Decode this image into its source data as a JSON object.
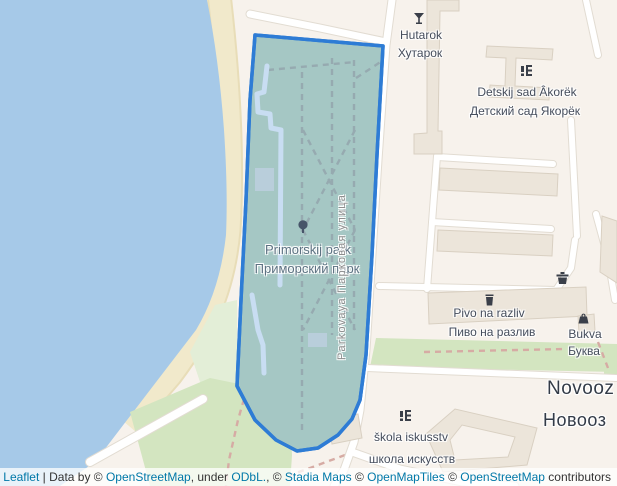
{
  "map": {
    "labels": {
      "hutarok": {
        "latin": "Hutarok",
        "cyrillic": "Хутарок"
      },
      "detsad": {
        "latin": "Detskij sad Âkorëk",
        "cyrillic": "Детский сад Якорёк"
      },
      "park": {
        "latin": "Primorskij park",
        "cyrillic": "Приморский парк"
      },
      "pivo": {
        "latin": "Pivo na razliv",
        "cyrillic": "Пиво на разлив"
      },
      "bukva": {
        "latin": "Bukva",
        "cyrillic": "Буква"
      },
      "shkola": {
        "latin": "škola iskusstv",
        "cyrillic": "школа искусств"
      },
      "place": {
        "latin": "Novooz",
        "cyrillic": "Новооз"
      },
      "street": {
        "text": "Parkovaya Парковая улица"
      }
    }
  },
  "colors": {
    "land": "#f7f2ec",
    "water": "#a6c9e8",
    "beach": "#f1e9cb",
    "beachEdge": "#e8ddb8",
    "green": "#d3e5c0",
    "greenLight": "#e3eed7",
    "road": "#ffffff",
    "roadCasing": "#e2dcd2",
    "building": "#ece5da",
    "buildingStroke": "#d9d0c2",
    "parkFill": "#a5c7c4",
    "parkStroke": "#2e7cd5",
    "pathBlue": "#c8ddf2",
    "dashGray": "#96aab0",
    "dashPink": "#d6aba4",
    "labelDark": "#454d5c",
    "labelPark": "#5c7181",
    "labelStreet": "#8e8e8e",
    "labelPlace": "#333b47",
    "link": "#0078a8"
  },
  "attribution": {
    "leaflet": "Leaflet",
    "sep1": " | Data by © ",
    "osm1": "OpenStreetMap",
    "sep2": ", under ",
    "odbl": "ODbL.",
    "sep3": ", © ",
    "stadia": "Stadia Maps",
    "sep4": " © ",
    "openmaptiles": "OpenMapTiles",
    "sep5": " © ",
    "osm2": "OpenStreetMap",
    "sep6": " contributors"
  }
}
